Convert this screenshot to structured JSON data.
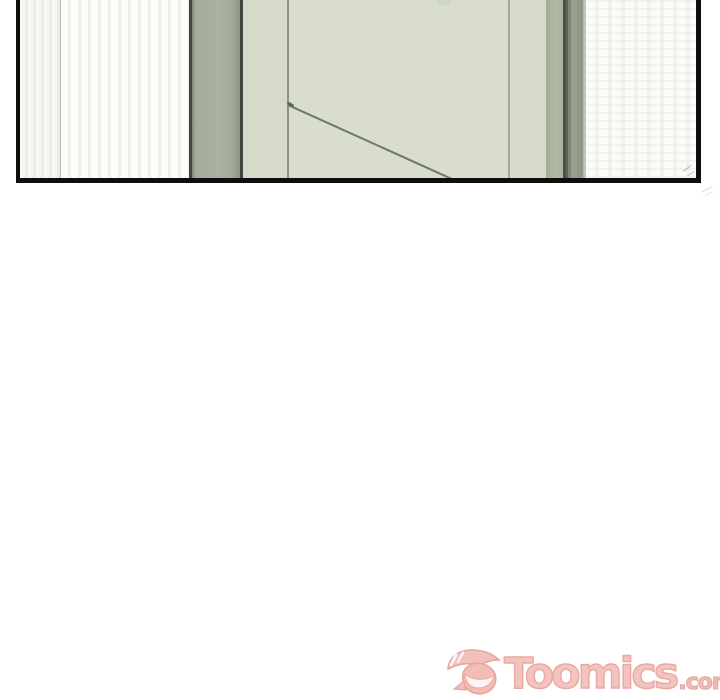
{
  "page": {
    "background_color": "#ffffff",
    "width_px": 720,
    "height_px": 700
  },
  "comic_panel": {
    "kind": "webtoon-panel-illustration",
    "scene": "interior wall with pale green door ajar, white curtains on both sides, top-clipped panel",
    "frame_color": "#0e0e0e",
    "colors": {
      "curtain_white": "#fbfbf9",
      "curtain_stripe": "#eef0e9",
      "wall_sage": "#a9af9e",
      "door_pale_green": "#d8ddcc",
      "door_strip": "#d6dbca",
      "gray_green_jamb": "#8f978a",
      "dark_frame_line": "#3f463c",
      "diagonal_shadow_line": "#6f766a"
    }
  },
  "watermark": {
    "brand_text": "Toomics",
    "domain_suffix": ".com",
    "text_fill_color": "#f3c0ba",
    "text_outline_color": "#e9a19a",
    "icon": "toomics-mascot-winking-face"
  }
}
